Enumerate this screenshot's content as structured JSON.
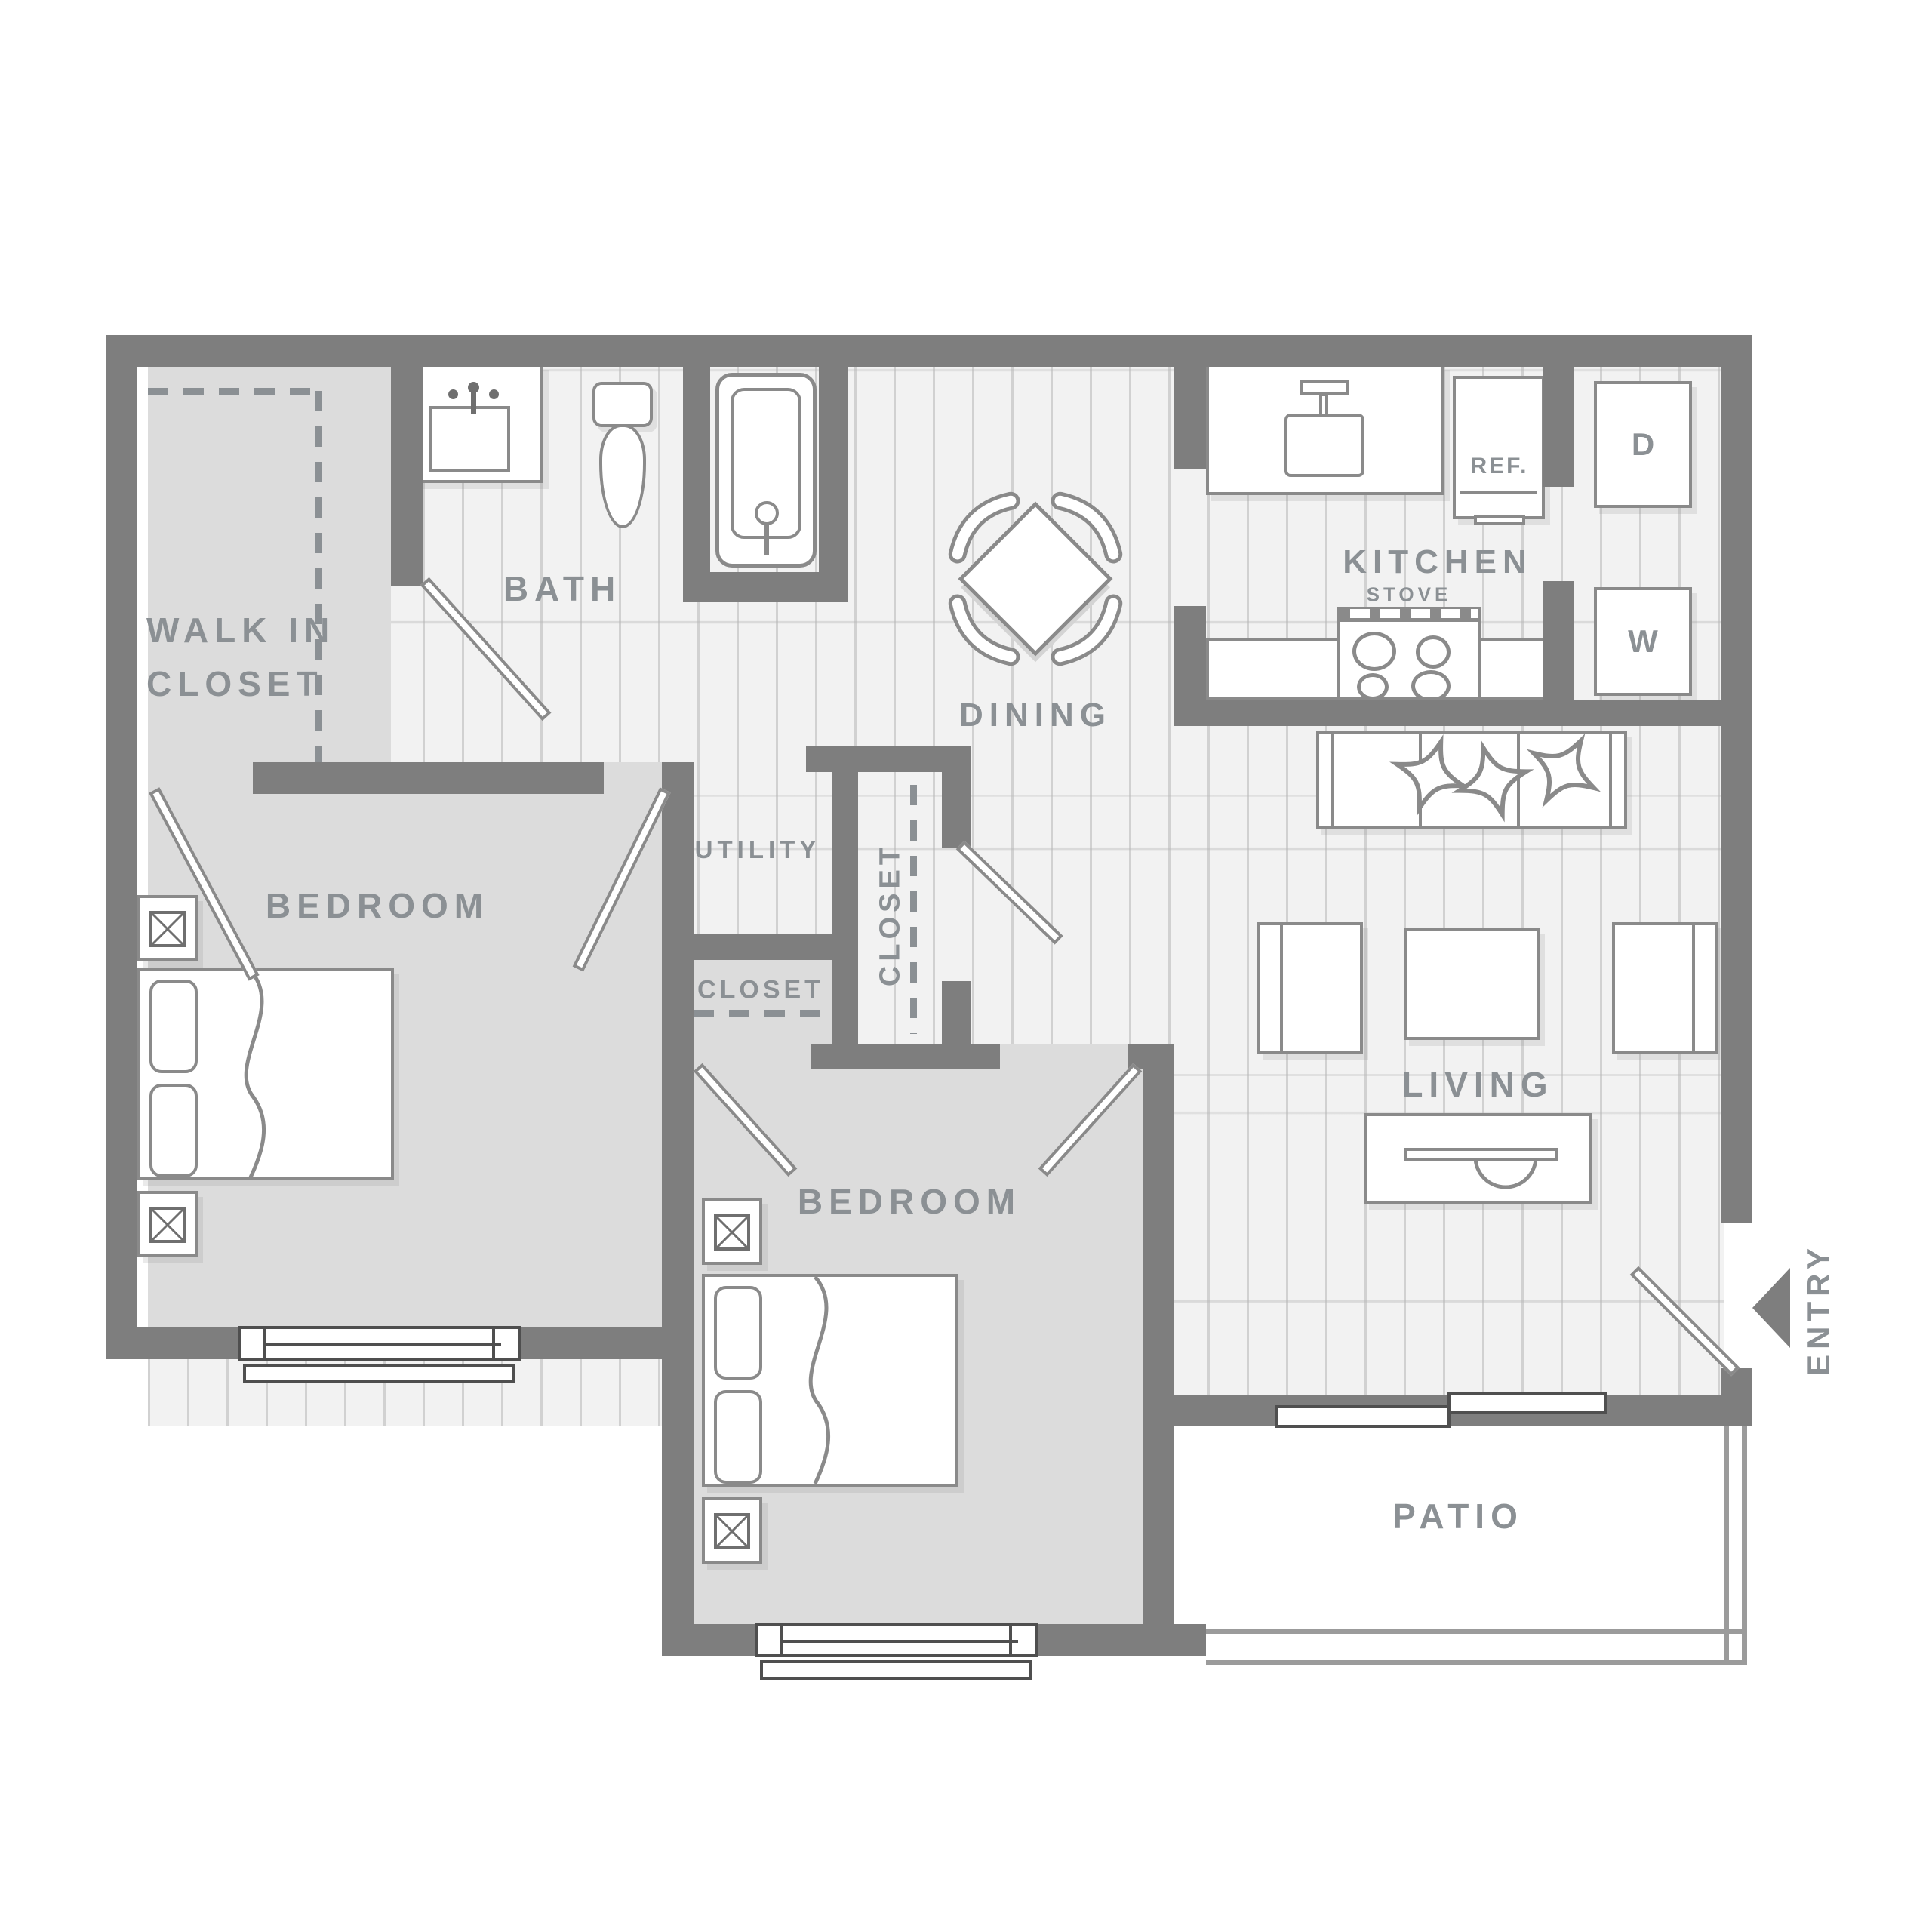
{
  "labels": {
    "walk_in_closet_line1": "WALK IN",
    "walk_in_closet_line2": "CLOSET",
    "bath": "BATH",
    "dining": "DINING",
    "kitchen": "KITCHEN",
    "stove": "STOVE",
    "refrigerator": "REF.",
    "dryer": "D",
    "washer": "W",
    "utility": "UTILITY",
    "hall_closet": "CLOSET",
    "bedroom_closet": "CLOSET",
    "bedroom_left": "BEDROOM",
    "bedroom_center": "BEDROOM",
    "living": "LIVING",
    "patio": "PATIO",
    "entry": "ENTRY"
  },
  "colors": {
    "wall": "#7e7e7e",
    "carpet_floor": "#dcdcdc",
    "plank_floor": "#f2f2f2",
    "fixture_stroke": "#8a8a8a",
    "label_text": "#8b9094",
    "background": "#ffffff"
  }
}
